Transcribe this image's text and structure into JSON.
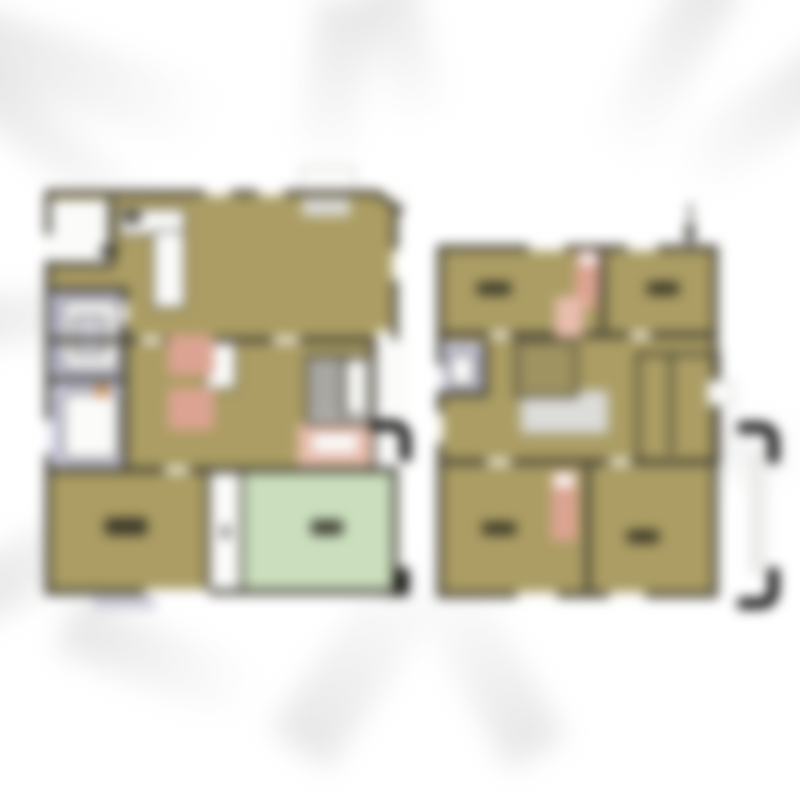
{
  "figure": {
    "kind": "floor-plan-blurred",
    "floors": [
      {
        "id": "left-plan"
      },
      {
        "id": "right-plan"
      }
    ]
  },
  "palette": {
    "bg": "#ffffff",
    "ray": "#e2e2e2",
    "floor": "#ab9d63",
    "wall": "#3f3c31",
    "white": "#fbfbfa",
    "lavender": "#c3c3dc",
    "lavender2": "#cdcde3",
    "green": "#cbdfbe",
    "salmon": "#dca392",
    "salmon2": "#e9bdae",
    "stairgray": "#b3b1ac",
    "voidgray": "#dcdcda",
    "label": "#2b2a20",
    "orange": "#cf8f4e",
    "stepgray": "#d9d9d6",
    "terrace": "#c9c9d6"
  }
}
